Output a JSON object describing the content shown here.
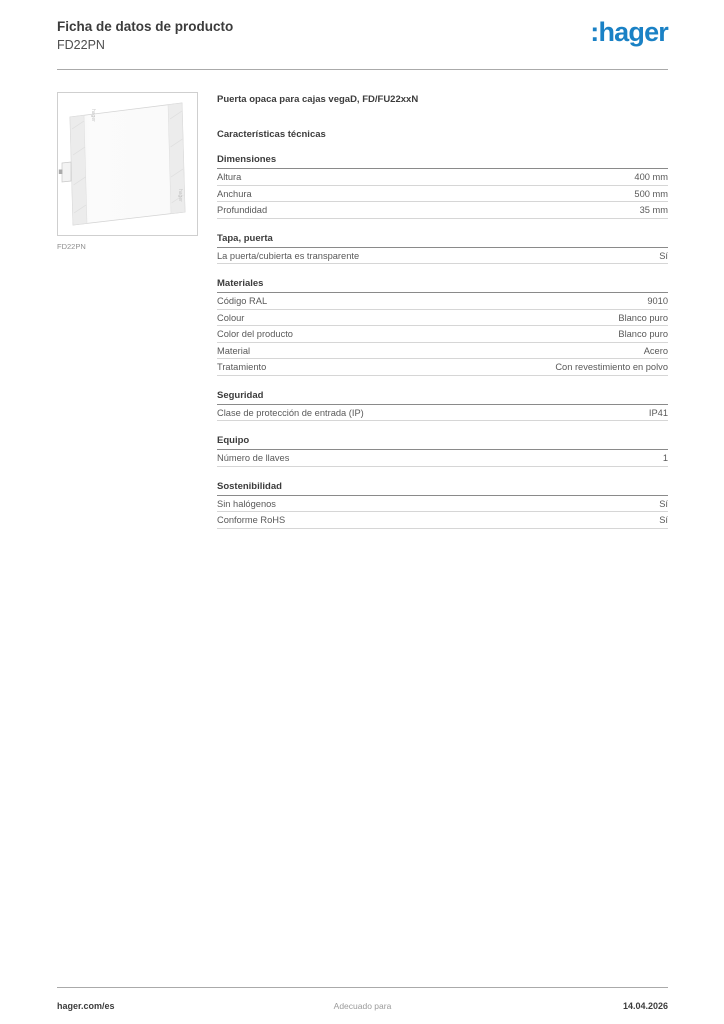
{
  "colors": {
    "brand_blue": "#1a81c5"
  },
  "header": {
    "title": "Ficha de datos de producto",
    "subtitle": "FD22PN",
    "logo_text": ":hager"
  },
  "product": {
    "image_caption": "FD22PN",
    "image_label": "hager",
    "title": "Puerta opaca para cajas vegaD, FD/FU22xxN",
    "characteristics_heading": "Características técnicas"
  },
  "sections": [
    {
      "title": "Dimensiones",
      "rows": [
        {
          "label": "Altura",
          "value": "400 mm"
        },
        {
          "label": "Anchura",
          "value": "500 mm"
        },
        {
          "label": "Profundidad",
          "value": "35 mm"
        }
      ]
    },
    {
      "title": "Tapa, puerta",
      "rows": [
        {
          "label": "La puerta/cubierta es transparente",
          "value": "Sí"
        }
      ]
    },
    {
      "title": "Materiales",
      "rows": [
        {
          "label": "Código RAL",
          "value": "9010"
        },
        {
          "label": "Colour",
          "value": "Blanco puro"
        },
        {
          "label": "Color del producto",
          "value": "Blanco puro"
        },
        {
          "label": "Material",
          "value": "Acero"
        },
        {
          "label": "Tratamiento",
          "value": "Con revestimiento en polvo"
        }
      ]
    },
    {
      "title": "Seguridad",
      "rows": [
        {
          "label": "Clase de protección de entrada (IP)",
          "value": "IP41"
        }
      ]
    },
    {
      "title": "Equipo",
      "rows": [
        {
          "label": "Número de llaves",
          "value": "1"
        }
      ]
    },
    {
      "title": "Sostenibilidad",
      "rows": [
        {
          "label": "Sin halógenos",
          "value": "Sí"
        },
        {
          "label": "Conforme RoHS",
          "value": "Sí"
        }
      ]
    }
  ],
  "footer": {
    "left": "hager.com/es",
    "center": "Adecuado para",
    "right": "14.04.2026"
  }
}
